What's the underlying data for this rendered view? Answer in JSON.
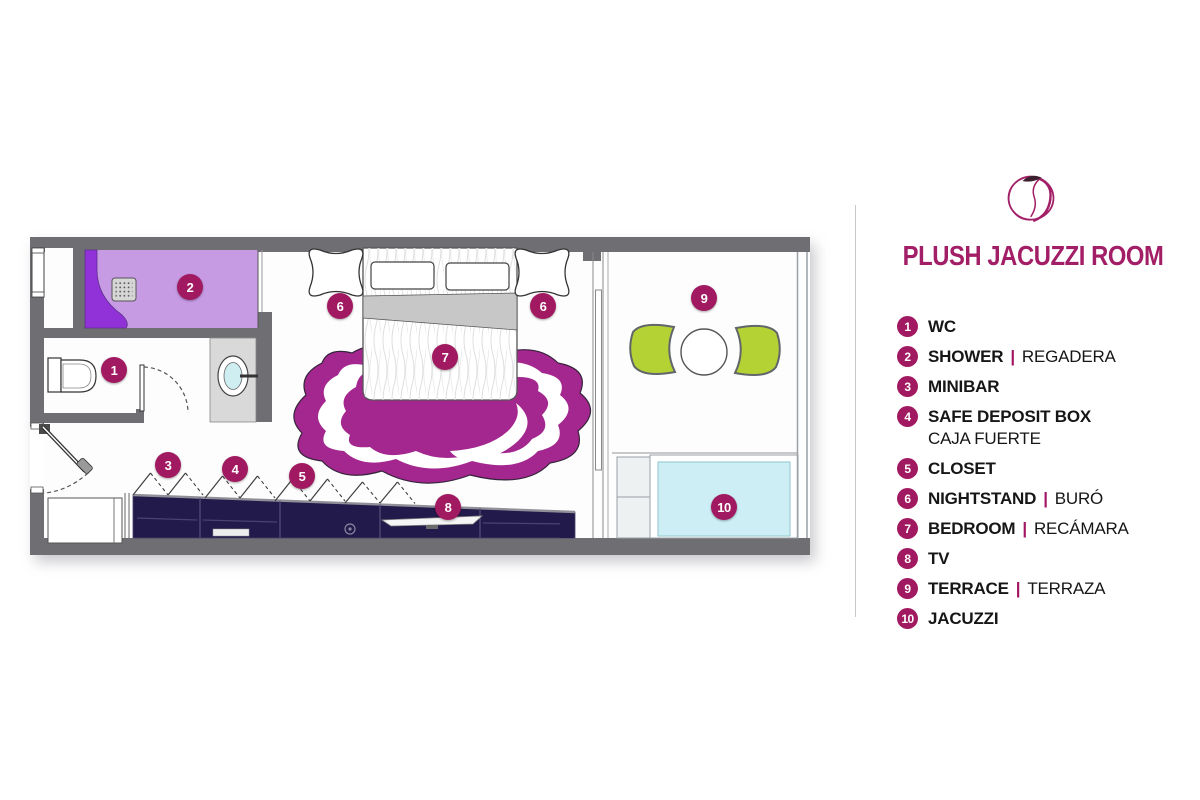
{
  "title": "PLUSH JACUZZI ROOM",
  "brand": {
    "logo_icon": "apple-scribble-logo"
  },
  "colors": {
    "accent": "#a21e66",
    "badge": "#a11960",
    "wall_grey": "#6e6e73",
    "shower_light_purple": "#c79ae4",
    "shower_dark_purple": "#9132d8",
    "rug_magenta": "#a3278f",
    "cabinet_navy": "#221a4a",
    "chair_green": "#b5d235",
    "jacuzzi_cyan": "#cdeef5",
    "counter_grey": "#d9d9d9"
  },
  "legend": {
    "items": [
      {
        "num": "1",
        "label": "WC"
      },
      {
        "num": "2",
        "label": "SHOWER",
        "sep": "|",
        "secondary": "REGADERA"
      },
      {
        "num": "3",
        "label": "MINIBAR"
      },
      {
        "num": "4",
        "label": "SAFE DEPOSIT BOX",
        "secondary": "CAJA FUERTE",
        "stacked": true
      },
      {
        "num": "5",
        "label": "CLOSET"
      },
      {
        "num": "6",
        "label": "NIGHTSTAND",
        "sep": "|",
        "secondary": "BURÓ"
      },
      {
        "num": "7",
        "label": "BEDROOM",
        "sep": "|",
        "secondary": "RECÁMARA"
      },
      {
        "num": "8",
        "label": "TV"
      },
      {
        "num": "9",
        "label": "TERRACE",
        "sep": "|",
        "secondary": "TERRAZA"
      },
      {
        "num": "10",
        "label": "JACUZZI"
      }
    ]
  },
  "floorplan": {
    "markers": [
      {
        "num": "1",
        "area": "wc"
      },
      {
        "num": "2",
        "area": "shower"
      },
      {
        "num": "3",
        "area": "minibar"
      },
      {
        "num": "4",
        "area": "safe-deposit-box"
      },
      {
        "num": "5",
        "area": "closet"
      },
      {
        "num": "6",
        "area": "nightstand-left"
      },
      {
        "num": "6",
        "area": "nightstand-right"
      },
      {
        "num": "7",
        "area": "bedroom"
      },
      {
        "num": "8",
        "area": "tv"
      },
      {
        "num": "9",
        "area": "terrace"
      },
      {
        "num": "10",
        "area": "jacuzzi"
      }
    ]
  }
}
